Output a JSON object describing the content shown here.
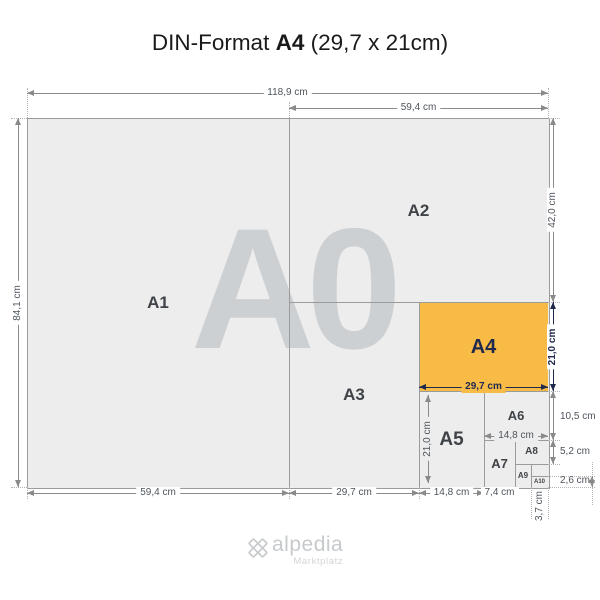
{
  "title": {
    "prefix": "DIN-Format ",
    "highlight": "A4",
    "suffix": " (29,7 x 21cm)"
  },
  "logo": {
    "name": "alpedia",
    "tagline": "Marktplatz",
    "icon": "clover-icon"
  },
  "colors": {
    "page_bg": "#ffffff",
    "sheet_fill": "#ededed",
    "sheet_line": "#9b9b9b",
    "highlight_orange": "#f8bc46",
    "highlight_navy": "#20294d",
    "dim_line": "#8a8a8a",
    "dim_text": "#4e555c",
    "ext_line": "#b4b4b4",
    "box_label": "#3f4347",
    "watermark": "#cdd0d3",
    "logo_gray": "#c7cacc"
  },
  "diagram": {
    "watermark": {
      "text": "A0",
      "cx": 292,
      "cy": 289,
      "size": 172,
      "color": "#cdd0d3"
    },
    "boxes": [
      {
        "id": "A0",
        "label": "",
        "x": 27,
        "y": 118,
        "w": 521,
        "h": 369,
        "fill": "#ededed",
        "fs": 0
      },
      {
        "id": "A1",
        "label": "A1",
        "x": 27,
        "y": 118,
        "w": 262,
        "h": 369,
        "fs": 17
      },
      {
        "id": "A2",
        "label": "A2",
        "x": 289,
        "y": 118,
        "w": 259,
        "h": 184,
        "fs": 17
      },
      {
        "id": "A3",
        "label": "A3",
        "x": 289,
        "y": 302,
        "w": 130,
        "h": 185,
        "fs": 17
      },
      {
        "id": "A4",
        "label": "A4",
        "x": 419,
        "y": 302,
        "w": 129,
        "h": 89,
        "fill": "#f8bc46",
        "color": "#20294d",
        "fs": 20
      },
      {
        "id": "A5",
        "label": "A5",
        "x": 419,
        "y": 391,
        "w": 65,
        "h": 96,
        "fs": 19
      },
      {
        "id": "A6",
        "label": "A6",
        "x": 484,
        "y": 391,
        "w": 64,
        "h": 49,
        "fs": 13
      },
      {
        "id": "A7",
        "label": "A7",
        "x": 484,
        "y": 440,
        "w": 31,
        "h": 47,
        "fs": 13
      },
      {
        "id": "A8",
        "label": "A8",
        "x": 515,
        "y": 440,
        "w": 33,
        "h": 24,
        "fs": 10
      },
      {
        "id": "A9",
        "label": "A9",
        "x": 515,
        "y": 464,
        "w": 16,
        "h": 23,
        "fs": 8
      },
      {
        "id": "A10",
        "label": "A10",
        "x": 531,
        "y": 476,
        "w": 17,
        "h": 11,
        "fs": 6
      }
    ],
    "lines": [
      {
        "dir": "v",
        "x": 289,
        "y": 118,
        "len": 369
      },
      {
        "dir": "h",
        "x": 289,
        "y": 302,
        "len": 259
      },
      {
        "dir": "v",
        "x": 419,
        "y": 302,
        "len": 185
      },
      {
        "dir": "h",
        "x": 419,
        "y": 391,
        "len": 129
      },
      {
        "dir": "v",
        "x": 484,
        "y": 391,
        "len": 96
      },
      {
        "dir": "h",
        "x": 484,
        "y": 440,
        "len": 64
      },
      {
        "dir": "v",
        "x": 515,
        "y": 440,
        "len": 47
      },
      {
        "dir": "h",
        "x": 515,
        "y": 464,
        "len": 33
      },
      {
        "dir": "v",
        "x": 531,
        "y": 464,
        "len": 23
      },
      {
        "dir": "h",
        "x": 531,
        "y": 476,
        "len": 17
      }
    ],
    "dims": [
      {
        "label": "118,9 cm",
        "dir": "h",
        "x": 27,
        "y": 93,
        "len": 521
      },
      {
        "label": "59,4 cm",
        "dir": "h",
        "x": 289,
        "y": 108,
        "len": 259
      },
      {
        "label": "84,1 cm",
        "dir": "v",
        "x": 18,
        "y": 118,
        "len": 369,
        "rot": true
      },
      {
        "label": "42,0 cm",
        "dir": "v",
        "x": 553,
        "y": 118,
        "len": 184,
        "rot": true
      },
      {
        "label": "21,0 cm",
        "dir": "v",
        "x": 553,
        "y": 302,
        "len": 89,
        "rot": true,
        "navy": true
      },
      {
        "label": "10,5 cm",
        "dir": "v",
        "x": 553,
        "y": 391,
        "len": 49,
        "side": true,
        "ly": 417
      },
      {
        "label": "5,2 cm",
        "dir": "v",
        "x": 553,
        "y": 440,
        "len": 24,
        "side": true,
        "ly": 452
      },
      {
        "label": "2,6 cm",
        "dir": "v",
        "x": 592,
        "y": 476,
        "len": 11,
        "side": true,
        "lx": 560,
        "ly": 481
      },
      {
        "label": "29,7 cm",
        "dir": "h",
        "x": 419,
        "y": 387,
        "len": 129,
        "navy": true,
        "bg": "#f8bc46"
      },
      {
        "label": "21,0 cm",
        "dir": "v",
        "x": 428,
        "y": 395,
        "len": 88,
        "rot": true,
        "bg": "#ededed"
      },
      {
        "label": "14,8 cm",
        "dir": "h",
        "x": 484,
        "y": 436,
        "len": 64,
        "bg": "#ededed"
      },
      {
        "label": "59,4 cm",
        "dir": "h",
        "x": 27,
        "y": 493,
        "len": 262
      },
      {
        "label": "29,7 cm",
        "dir": "h",
        "x": 289,
        "y": 493,
        "len": 130
      },
      {
        "label": "14,8 cm",
        "dir": "h",
        "x": 419,
        "y": 493,
        "len": 65
      },
      {
        "label": "7,4 cm",
        "dir": "h",
        "x": 484,
        "y": 493,
        "len": 31
      },
      {
        "label": "3,7 cm",
        "noline": true,
        "rot": true,
        "lx": 540,
        "ly": 506
      }
    ],
    "exts": [
      {
        "dir": "v",
        "x": 27,
        "y": 88,
        "len": 30
      },
      {
        "dir": "v",
        "x": 548,
        "y": 88,
        "len": 30
      },
      {
        "dir": "v",
        "x": 289,
        "y": 102,
        "len": 16
      },
      {
        "dir": "h",
        "x": 11,
        "y": 118,
        "len": 16
      },
      {
        "dir": "h",
        "x": 11,
        "y": 487,
        "len": 16
      },
      {
        "dir": "h",
        "x": 548,
        "y": 118,
        "len": 12
      },
      {
        "dir": "h",
        "x": 548,
        "y": 302,
        "len": 12
      },
      {
        "dir": "h",
        "x": 548,
        "y": 391,
        "len": 12
      },
      {
        "dir": "h",
        "x": 548,
        "y": 440,
        "len": 12
      },
      {
        "dir": "h",
        "x": 548,
        "y": 464,
        "len": 12
      },
      {
        "dir": "h",
        "x": 548,
        "y": 476,
        "len": 47
      },
      {
        "dir": "h",
        "x": 548,
        "y": 487,
        "len": 47
      },
      {
        "dir": "v",
        "x": 27,
        "y": 487,
        "len": 12
      },
      {
        "dir": "v",
        "x": 289,
        "y": 487,
        "len": 12
      },
      {
        "dir": "v",
        "x": 419,
        "y": 487,
        "len": 12
      },
      {
        "dir": "v",
        "x": 484,
        "y": 487,
        "len": 12
      },
      {
        "dir": "v",
        "x": 515,
        "y": 487,
        "len": 12
      },
      {
        "dir": "v",
        "x": 531,
        "y": 487,
        "len": 32
      },
      {
        "dir": "v",
        "x": 548,
        "y": 487,
        "len": 32
      },
      {
        "dir": "v",
        "x": 592,
        "y": 462,
        "len": 43
      }
    ]
  }
}
